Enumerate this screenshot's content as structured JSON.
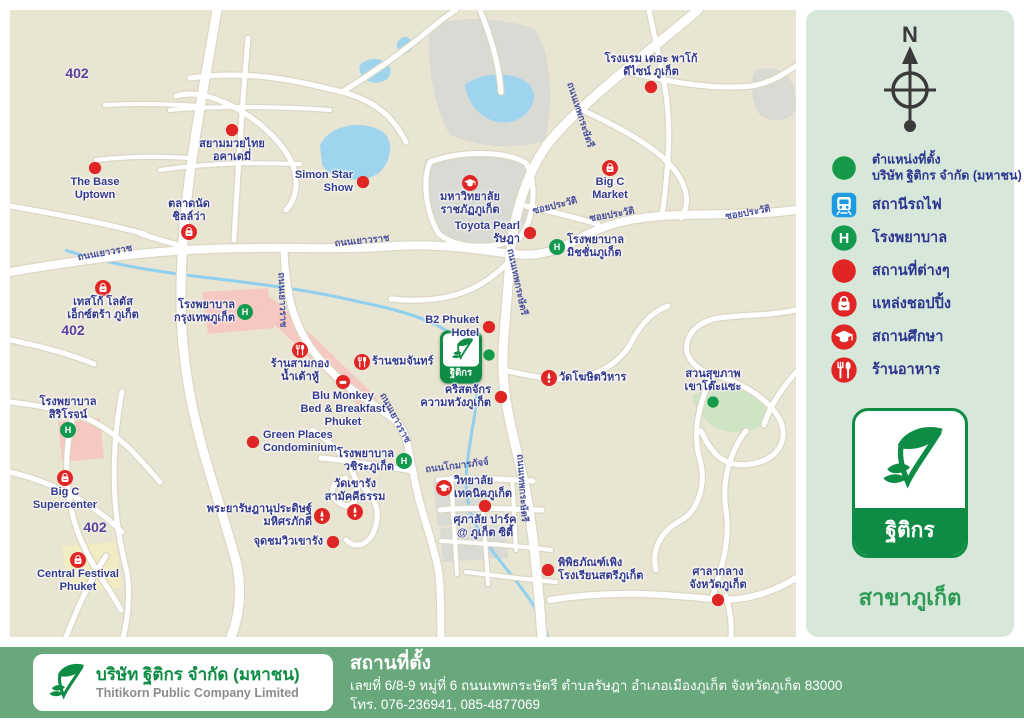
{
  "map": {
    "company_marker": {
      "x": 451,
      "y": 347,
      "label": "ฐิติกร"
    },
    "road_shields": [
      {
        "text": "402",
        "x": 67,
        "y": 63
      },
      {
        "text": "402",
        "x": 63,
        "y": 320
      },
      {
        "text": "402",
        "x": 85,
        "y": 517
      }
    ],
    "road_labels": [
      {
        "text": "ถนนเยาวราช",
        "x": 95,
        "y": 243,
        "rot": -10
      },
      {
        "text": "ถนนเยาวราช",
        "x": 352,
        "y": 231,
        "rot": -6
      },
      {
        "text": "ถนนเยาวราช",
        "x": 272,
        "y": 290,
        "rot": 88
      },
      {
        "text": "ถนนเยาวราช",
        "x": 385,
        "y": 408,
        "rot": 62
      },
      {
        "text": "ถนนเทพกระษัตรี",
        "x": 570,
        "y": 105,
        "rot": 72
      },
      {
        "text": "ถนนเทพกระษัตรี",
        "x": 507,
        "y": 272,
        "rot": 78
      },
      {
        "text": "ถนนเทพกระษัตรี",
        "x": 512,
        "y": 478,
        "rot": 86
      },
      {
        "text": "ซอยประวัติ",
        "x": 545,
        "y": 196,
        "rot": -14
      },
      {
        "text": "ซอยประวัติ",
        "x": 602,
        "y": 205,
        "rot": -10
      },
      {
        "text": "ซอยประวัติ",
        "x": 738,
        "y": 203,
        "rot": -10
      },
      {
        "text": "ถนนโกมารภัจจ์",
        "x": 447,
        "y": 456,
        "rot": -7
      }
    ],
    "markers": [
      {
        "type": "place",
        "x": 85,
        "y": 158,
        "lines": [
          "The Base",
          "Uptown"
        ],
        "lpos": "below"
      },
      {
        "type": "place",
        "x": 222,
        "y": 120,
        "lines": [
          "สยามมวยไทย",
          "อคาเดมี่"
        ],
        "lpos": "below"
      },
      {
        "type": "place",
        "x": 353,
        "y": 172,
        "lines": [
          "Simon Star",
          "Show"
        ],
        "lpos": "left"
      },
      {
        "type": "shopping",
        "x": 179,
        "y": 222,
        "lines": [
          "ตลาดนัด",
          "ชิลล์ว่า"
        ],
        "lpos": "above"
      },
      {
        "type": "shopping",
        "x": 93,
        "y": 278,
        "lines": [
          "เทสโก้ โลตัส",
          "เอ็กซ์ตร้า ภูเก็ต"
        ],
        "lpos": "below"
      },
      {
        "type": "place",
        "x": 641,
        "y": 77,
        "lines": [
          "โรงแรม เดอะ พาโก้",
          "ดีไซน์ ภูเก็ต"
        ],
        "lpos": "above"
      },
      {
        "type": "education",
        "x": 460,
        "y": 173,
        "lines": [
          "มหาวิทยาลัย",
          "ราชภัฏภูเก็ต"
        ],
        "lpos": "below"
      },
      {
        "type": "shopping",
        "x": 600,
        "y": 158,
        "lines": [
          "Big C",
          "Market"
        ],
        "lpos": "below"
      },
      {
        "type": "place",
        "x": 520,
        "y": 223,
        "lines": [
          "Toyota Pearl",
          "รัษฎา"
        ],
        "lpos": "left"
      },
      {
        "type": "hospital",
        "x": 547,
        "y": 237,
        "lines": [
          "โรงพยาบาล",
          "มิชชั่นภูเก็ต"
        ],
        "lpos": "right"
      },
      {
        "type": "hospital",
        "x": 235,
        "y": 302,
        "lines": [
          "โรงพยาบาล",
          "กรุงเทพภูเก็ต"
        ],
        "lpos": "left"
      },
      {
        "type": "restaurant",
        "x": 290,
        "y": 340,
        "lines": [
          "ร้านสามกอง",
          "น้ำเต้าหู้"
        ],
        "lpos": "below"
      },
      {
        "type": "restaurant",
        "x": 352,
        "y": 352,
        "lines": [
          "ร้านชมจันทร์"
        ],
        "lpos": "right"
      },
      {
        "type": "lodging",
        "x": 333,
        "y": 372,
        "lines": [
          "Blu Monkey",
          "Bed & Breakfast",
          "Phuket"
        ],
        "lpos": "below"
      },
      {
        "type": "place",
        "x": 479,
        "y": 317,
        "lines": [
          "B2 Phuket",
          "Hotel"
        ],
        "lpos": "left"
      },
      {
        "type": "green-dot",
        "x": 479,
        "y": 345,
        "lines": [],
        "lpos": "right"
      },
      {
        "type": "place",
        "x": 491,
        "y": 387,
        "lines": [
          "คริสตจักร",
          "ความหวังภูเก็ต"
        ],
        "lpos": "left"
      },
      {
        "type": "temple",
        "x": 539,
        "y": 368,
        "lines": [
          "วัดโฆษิตวิหาร"
        ],
        "lpos": "right"
      },
      {
        "type": "green-dot",
        "x": 703,
        "y": 392,
        "lines": [
          "สวนสุขภาพ",
          "เขาโต๊ะแซะ"
        ],
        "lpos": "above"
      },
      {
        "type": "hospital",
        "x": 58,
        "y": 420,
        "lines": [
          "โรงพยาบาล",
          "สิริโรจน์"
        ],
        "lpos": "above"
      },
      {
        "type": "shopping",
        "x": 55,
        "y": 468,
        "lines": [
          "Big C",
          "Supercenter"
        ],
        "lpos": "below"
      },
      {
        "type": "place",
        "x": 243,
        "y": 432,
        "lines": [
          "Green Places",
          "Condominium"
        ],
        "lpos": "right"
      },
      {
        "type": "hospital",
        "x": 394,
        "y": 451,
        "lines": [
          "โรงพยาบาล",
          "วชิระภูเก็ต"
        ],
        "lpos": "left"
      },
      {
        "type": "temple",
        "x": 345,
        "y": 502,
        "lines": [
          "วัดเขารัง",
          "สามัคคีธรรม"
        ],
        "lpos": "above"
      },
      {
        "type": "temple",
        "x": 312,
        "y": 506,
        "lines": [
          "พระยารัษฎานุประดิษฐ์",
          "มหิศรภักดี"
        ],
        "lpos": "left"
      },
      {
        "type": "place",
        "x": 323,
        "y": 532,
        "lines": [
          "จุดชมวิวเขารัง"
        ],
        "lpos": "left"
      },
      {
        "type": "shopping",
        "x": 68,
        "y": 550,
        "lines": [
          "Central Festival",
          "Phuket"
        ],
        "lpos": "below"
      },
      {
        "type": "education",
        "x": 434,
        "y": 478,
        "lines": [
          "วิทยาลัย",
          "เทคนิคภูเก็ต"
        ],
        "lpos": "right"
      },
      {
        "type": "place",
        "x": 475,
        "y": 496,
        "lines": [
          "ศุภาลัย ปาร์ค",
          "@ ภูเก็ต ซิตี้"
        ],
        "lpos": "below"
      },
      {
        "type": "place",
        "x": 538,
        "y": 560,
        "lines": [
          "พิพิธภัณฑ์เพิง",
          "โรงเรียนสตรีภูเก็ต"
        ],
        "lpos": "right"
      },
      {
        "type": "place",
        "x": 708,
        "y": 590,
        "lines": [
          "ศาลากลาง",
          "จังหวัดภูเก็ต"
        ],
        "lpos": "above"
      }
    ]
  },
  "legend": {
    "north_label": "N",
    "items": [
      {
        "icon": "green-dot",
        "lines": [
          "ตำแหน่งที่ตั้ง",
          "บริษัท ฐิติกร จำกัด (มหาชน)"
        ]
      },
      {
        "icon": "train",
        "lines": [
          "สถานีรถไฟ"
        ]
      },
      {
        "icon": "hospital",
        "lines": [
          "โรงพยาบาล"
        ]
      },
      {
        "icon": "place",
        "lines": [
          "สถานที่ต่างๆ"
        ]
      },
      {
        "icon": "shopping",
        "lines": [
          "แหล่งชอปปิ้ง"
        ]
      },
      {
        "icon": "education",
        "lines": [
          "สถานศึกษา"
        ]
      },
      {
        "icon": "restaurant",
        "lines": [
          "ร้านอาหาร"
        ]
      }
    ],
    "logo_text": "ฐิติกร",
    "branch_label": "สาขาภูเก็ต"
  },
  "footer": {
    "company_th": "บริษัท ฐิติกร จำกัด (มหาชน)",
    "company_en": "Thitikorn Public Company Limited",
    "location_title": "สถานที่ตั้ง",
    "address_line": "เลขที่ 6/8-9 หมู่ที่ 6 ถนนเทพกระษัตรี ตำบลรัษฎา อำเภอเมืองภูเก็ต จังหวัดภูเก็ต 83000",
    "phone_line": "โทร. 076-236941, 085-4877069"
  },
  "colors": {
    "brand_green": "#0e8c45",
    "marker_red": "#e02525",
    "hospital_green": "#149a4e",
    "train_blue": "#1e9ae0",
    "label_navy": "#333a8e",
    "map_bg": "#e9e5d3",
    "panel_bg": "#d7e8da",
    "footer_green": "#69a87c",
    "water_blue": "#9fd4ee"
  }
}
